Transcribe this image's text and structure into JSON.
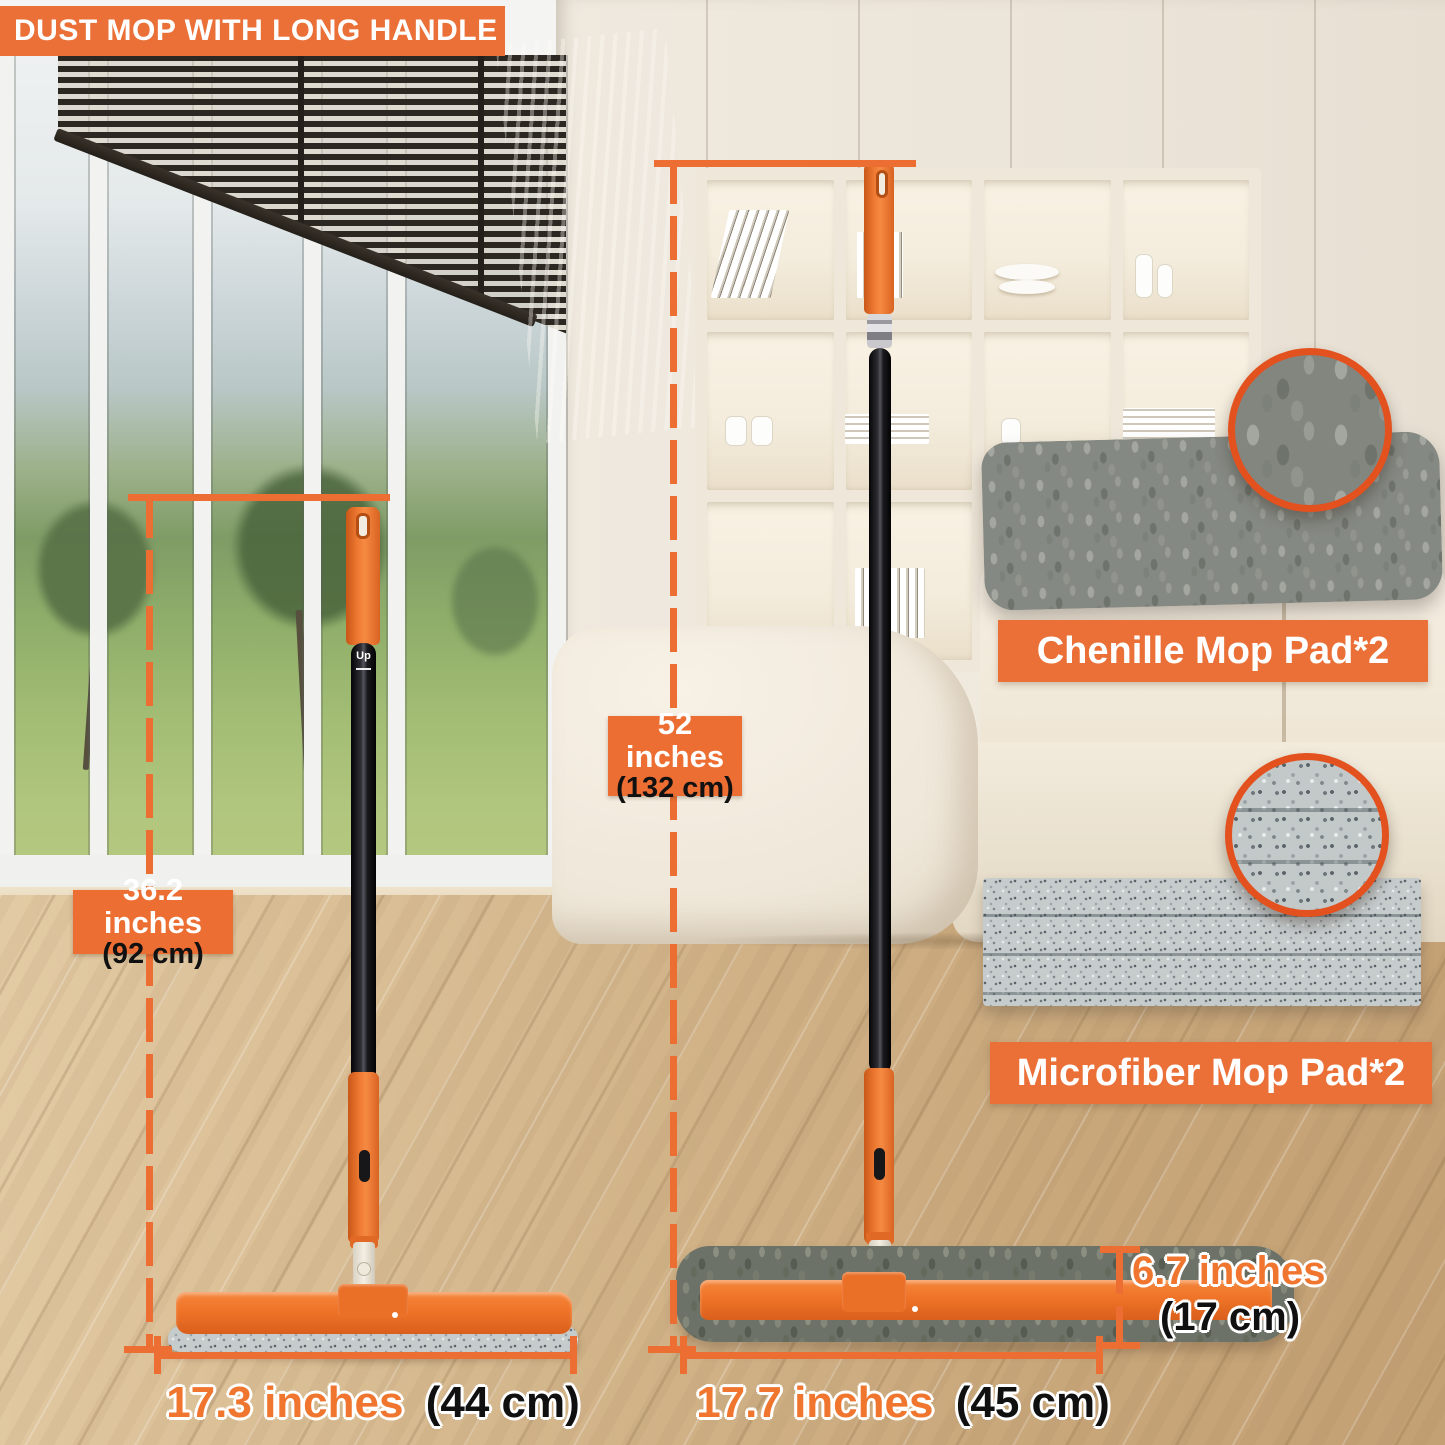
{
  "banner": {
    "title": "DUST MOP WITH LONG HANDLE"
  },
  "measurements": {
    "left_mop_height": {
      "primary": "36.2 inches",
      "secondary": "(92 cm)"
    },
    "right_mop_height": {
      "primary": "52 inches",
      "secondary": "(132 cm)"
    },
    "left_mop_width": {
      "primary": "17.3 inches",
      "secondary": "(44 cm)"
    },
    "right_mop_width": {
      "primary": "17.7 inches",
      "secondary": "(45 cm)"
    },
    "mop_head_depth": {
      "primary": "6.7 inches",
      "secondary": "(17 cm)"
    }
  },
  "pads": {
    "chenille": {
      "label": "Chenille Mop Pad*2"
    },
    "microfiber": {
      "label": "Microfiber Mop Pad*2"
    }
  },
  "handle": {
    "pole_mark": "Up"
  },
  "colors": {
    "accent_orange": "#EA7038",
    "dimension_orange": "#ED6E33",
    "circle_border_orange": "#E2511E"
  }
}
